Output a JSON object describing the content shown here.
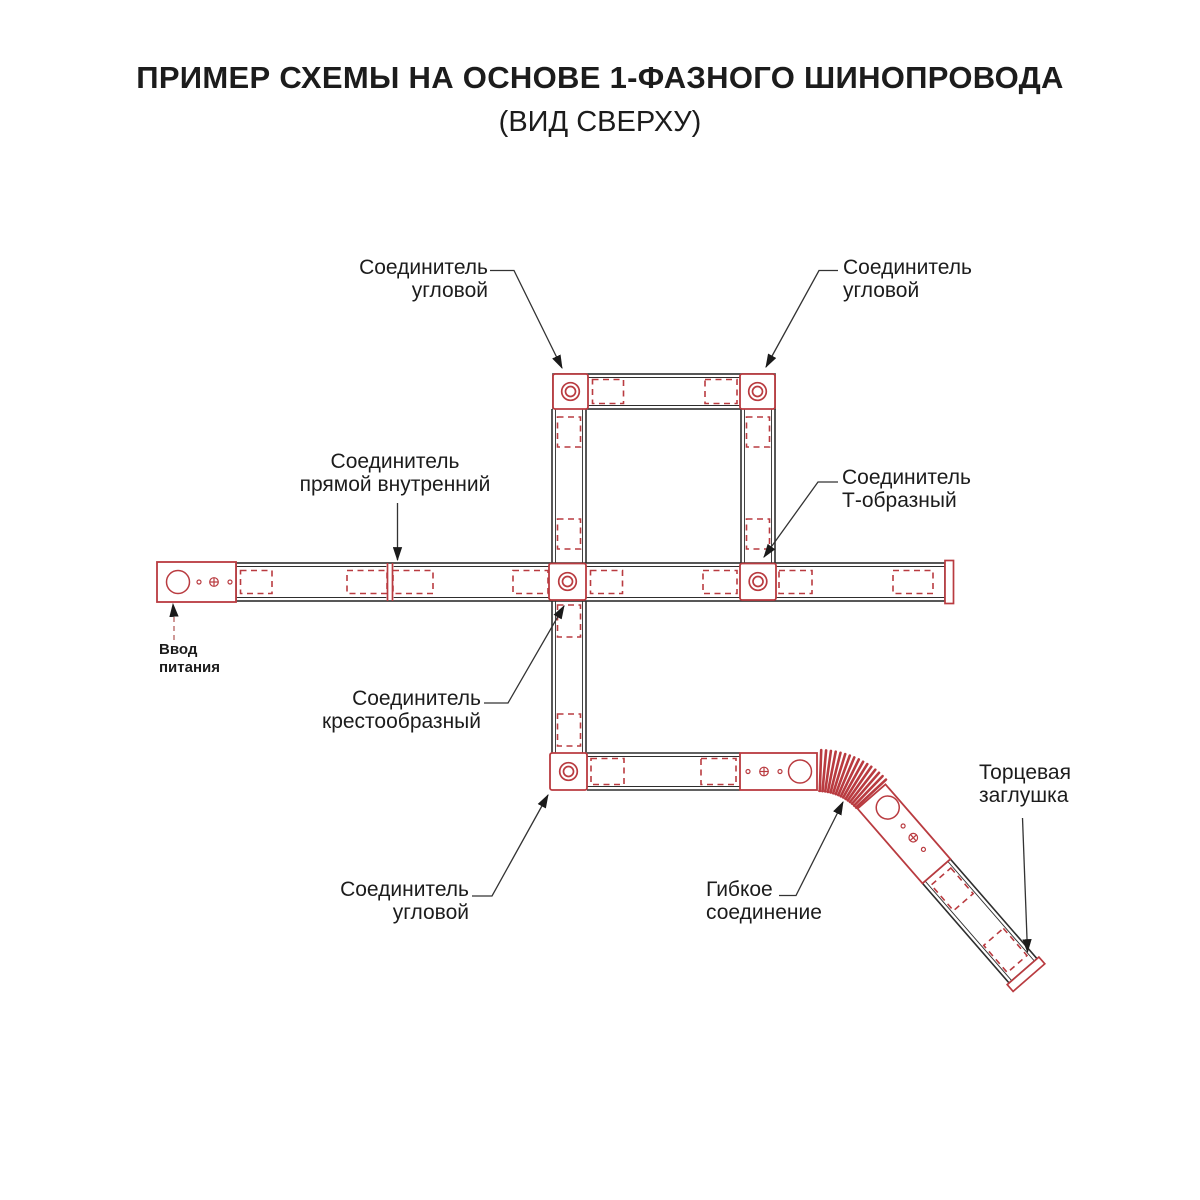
{
  "title": "ПРИМЕР СХЕМЫ НА ОСНОВЕ 1-ФАЗНОГО ШИНОПРОВОДА",
  "subtitle": "(ВИД СВЕРХУ)",
  "colors": {
    "accent_red": "#b93b40",
    "line_dark": "#2e2e2e",
    "text": "#1c1c1c",
    "background": "#ffffff"
  },
  "labels": {
    "corner_top_left": {
      "line1": "Соединитель",
      "line2": "угловой"
    },
    "corner_top_right": {
      "line1": "Соединитель",
      "line2": "угловой"
    },
    "straight_internal": {
      "line1": "Соединитель",
      "line2": "прямой внутренний"
    },
    "t_shaped": {
      "line1": "Соединитель",
      "line2": "Т-образный"
    },
    "power_input": {
      "line1": "Ввод",
      "line2": "питания"
    },
    "cross_shaped": {
      "line1": "Соединитель",
      "line2": "крестообразный"
    },
    "corner_bottom": {
      "line1": "Соединитель",
      "line2": "угловой"
    },
    "flexible": {
      "line1": "Гибкое",
      "line2": "соединение"
    },
    "end_cap": {
      "line1": "Торцевая",
      "line2": "заглушка"
    }
  }
}
